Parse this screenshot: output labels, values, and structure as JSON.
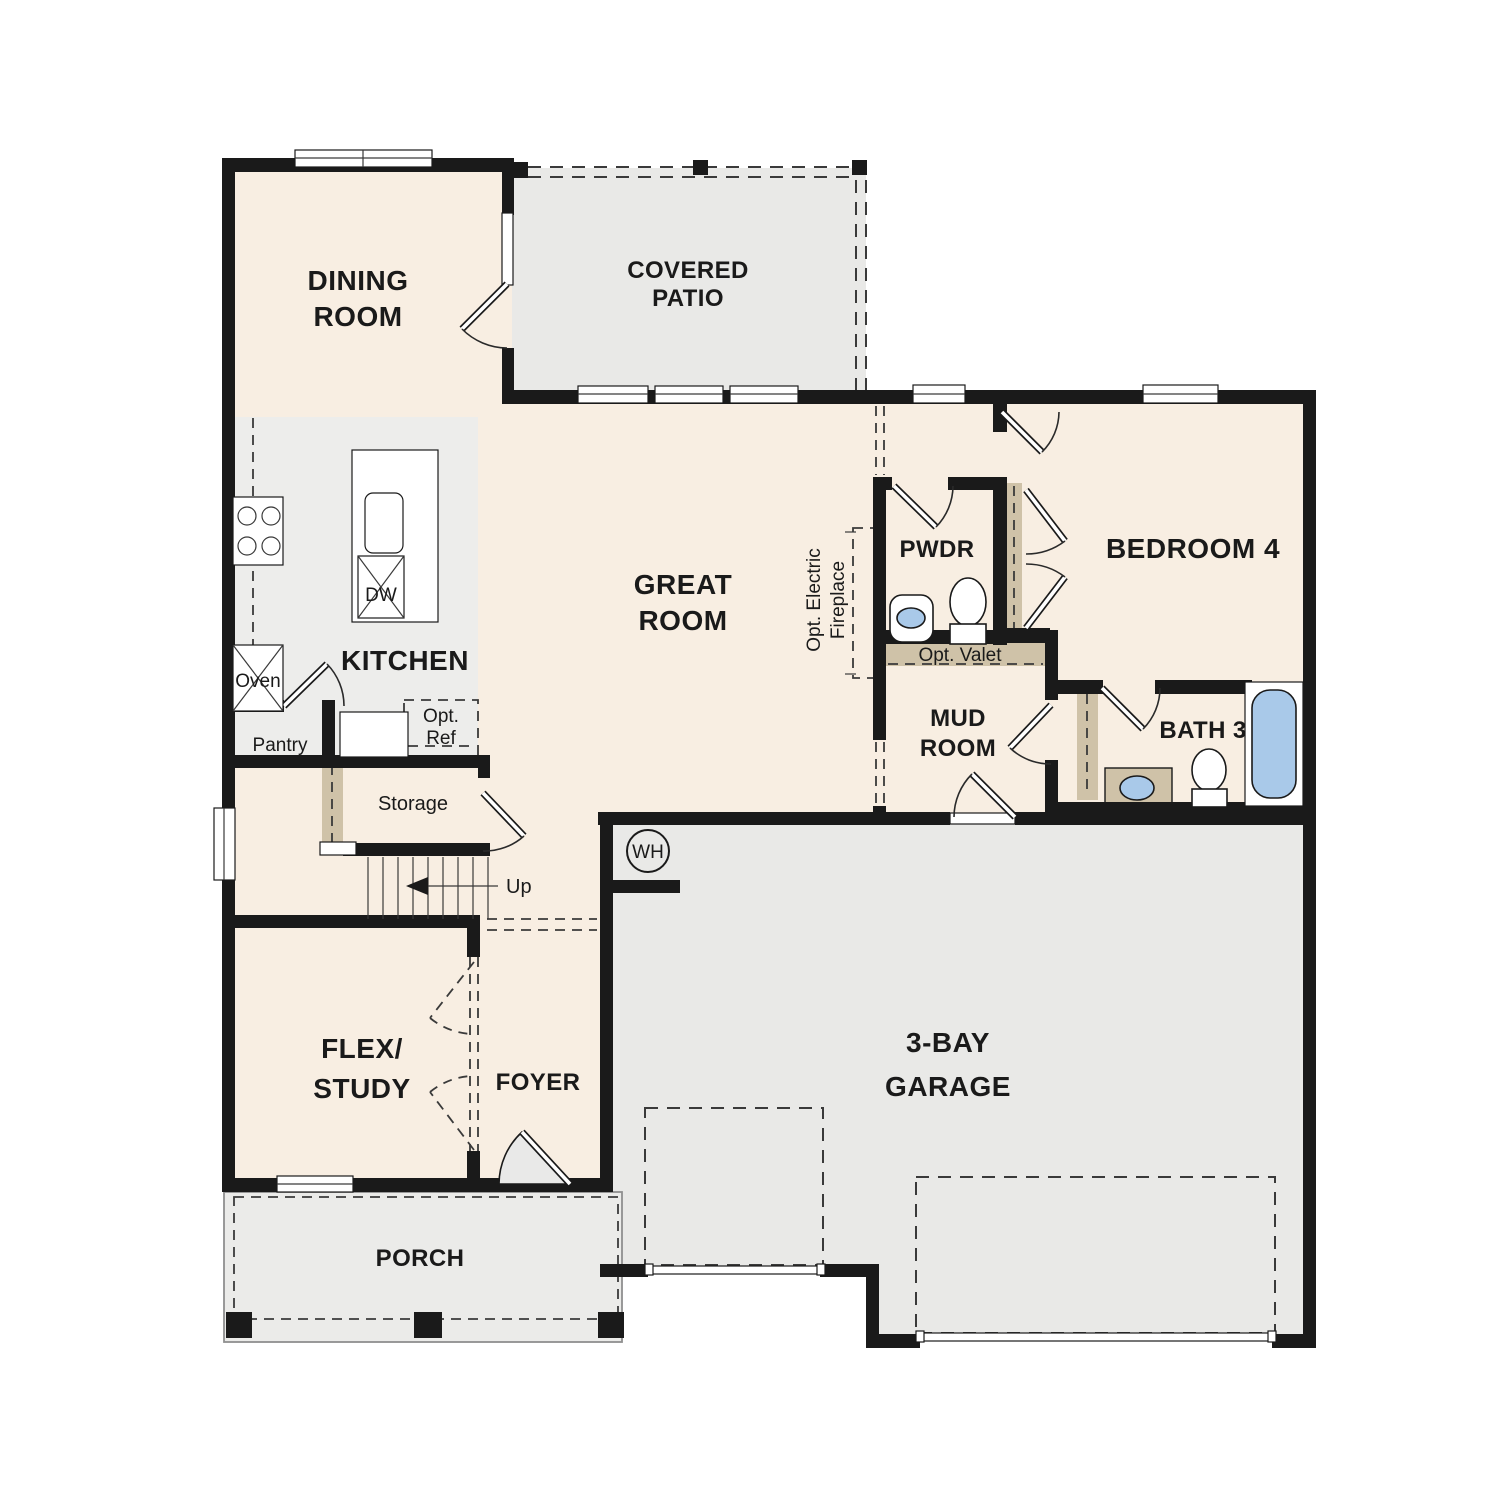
{
  "colors": {
    "wall": "#1a1a1a",
    "room_fill": "#f8eee2",
    "outdoor_fill": "#e9e9e7",
    "kitchen_fill": "#ededeb",
    "tan_fill": "#cfc2a8",
    "fixture_blue": "#a9c9e9",
    "text": "#1a1a1a"
  },
  "rooms": {
    "dining": {
      "line1": "DINING",
      "line2": "ROOM"
    },
    "covered_patio": {
      "line1": "COVERED",
      "line2": "PATIO"
    },
    "great_room": {
      "line1": "GREAT",
      "line2": "ROOM"
    },
    "kitchen": {
      "label": "KITCHEN"
    },
    "bedroom4": {
      "label": "BEDROOM 4"
    },
    "pwdr": {
      "label": "PWDR"
    },
    "mud_room": {
      "line1": "MUD",
      "line2": "ROOM"
    },
    "bath3": {
      "label": "BATH 3"
    },
    "flex_study": {
      "line1": "FLEX/",
      "line2": "STUDY"
    },
    "foyer": {
      "label": "FOYER"
    },
    "garage": {
      "line1": "3-BAY",
      "line2": "GARAGE"
    },
    "porch": {
      "label": "PORCH"
    }
  },
  "annotations": {
    "oven": "Oven",
    "dw": "DW",
    "pantry": "Pantry",
    "opt_ref_line1": "Opt.",
    "opt_ref_line2": "Ref",
    "storage": "Storage",
    "up": "Up",
    "water_heater": "WH",
    "opt_valet": "Opt. Valet",
    "fireplace_line1": "Opt. Electric",
    "fireplace_line2": "Fireplace"
  }
}
